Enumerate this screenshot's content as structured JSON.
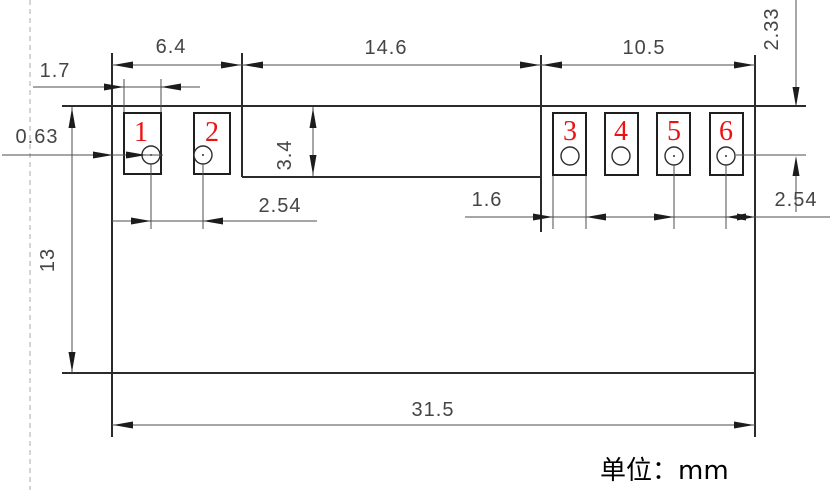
{
  "drawing": {
    "kind": "engineering dimension drawing of 6-pad component footprint",
    "unit_note": "单位：mm",
    "pads": {
      "numbers": [
        "1",
        "2",
        "3",
        "4",
        "5",
        "6"
      ]
    },
    "dims": {
      "top_left_span": "6.4",
      "top_middle_span": "14.6",
      "top_right_span": "10.5",
      "left_pad_width": "1.7",
      "left_edge_offset": "0.63",
      "middle_block_height": "3.4",
      "hole_center_from_top": "2.33",
      "body_height": "13",
      "left_pitch": "2.54",
      "right_pad_width": "1.6",
      "right_pitch": "2.54",
      "total_width": "31.5"
    },
    "colors": {
      "outline": "#2b2b2b",
      "dimension": "#4d4d4d",
      "pad_number_red": "#ee1111",
      "dashed_line": "#b9b9b9",
      "background": "#ffffff"
    }
  }
}
